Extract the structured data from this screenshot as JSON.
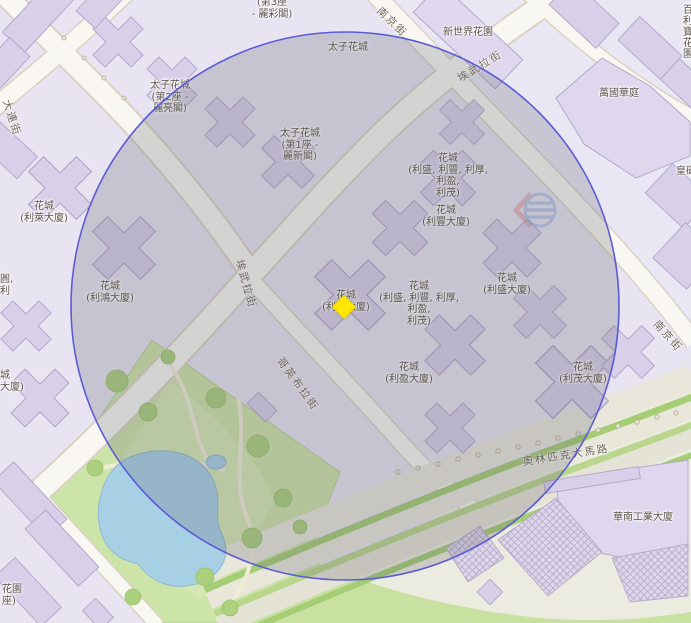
{
  "map": {
    "building_labels": [
      {
        "id": "prince-flower-city",
        "lines": [
          "太子花城"
        ],
        "x": 348,
        "y": 42
      },
      {
        "id": "prince-block3",
        "lines": [
          "(第3座",
          "- 麗彩閣)"
        ],
        "x": 272,
        "y": -3
      },
      {
        "id": "prince-block2",
        "lines": [
          "太子花城",
          "(第2座 -",
          "麗亮閣)"
        ],
        "x": 170,
        "y": 80
      },
      {
        "id": "prince-block1",
        "lines": [
          "太子花城",
          "(第1座 -",
          "麗新閣)"
        ],
        "x": 300,
        "y": 128
      },
      {
        "id": "new-world-garden",
        "lines": [
          "新世界花園"
        ],
        "x": 468,
        "y": 27
      },
      {
        "id": "van-kuok-garden",
        "lines": [
          "萬國華庭"
        ],
        "x": 619,
        "y": 88
      },
      {
        "id": "fa-seng-multi-north",
        "lines": [
          "花城",
          "(利盛, 利豐, 利厚,",
          "利盈,",
          "利茂)"
        ],
        "x": 448,
        "y": 153
      },
      {
        "id": "fa-seng-lei-fong",
        "lines": [
          "花城",
          "(利豐大廈)"
        ],
        "x": 446,
        "y": 205
      },
      {
        "id": "fa-seng-lei-seng",
        "lines": [
          "花城",
          "(利盛大廈)"
        ],
        "x": 507,
        "y": 273
      },
      {
        "id": "fa-seng-lei-loi",
        "lines": [
          "花城",
          "(利萊大廈)"
        ],
        "x": 44,
        "y": 201
      },
      {
        "id": "fragment-yuen",
        "lines": [
          "圓,",
          "利"
        ],
        "x": 0,
        "y": 274,
        "align": "left"
      },
      {
        "id": "fa-seng-lei-hung",
        "lines": [
          "花城",
          "(利鴻大廈)"
        ],
        "x": 110,
        "y": 281
      },
      {
        "id": "fa-seng-multi-central",
        "lines": [
          "花城",
          "(利盛, 利豐, 利厚,",
          "利盈,",
          "利茂)"
        ],
        "x": 419,
        "y": 281
      },
      {
        "id": "fa-seng-marker-building",
        "lines": [
          "花城",
          "(利　大廈)"
        ],
        "x": 346,
        "y": 290
      },
      {
        "id": "fa-seng-lei-ying",
        "lines": [
          "花城",
          "(利盈大廈)"
        ],
        "x": 409,
        "y": 362
      },
      {
        "id": "fa-seng-lei-mao",
        "lines": [
          "花城",
          "(利茂大廈)"
        ],
        "x": 583,
        "y": 362
      },
      {
        "id": "fragment-seng-left",
        "lines": [
          "城",
          "大廈)"
        ],
        "x": 0,
        "y": 370,
        "align": "left"
      },
      {
        "id": "wa-nam-industrial",
        "lines": [
          "華南工業大廈"
        ],
        "x": 643,
        "y": 512
      },
      {
        "id": "fragment-garden-sw",
        "lines": [
          "花園",
          "座)"
        ],
        "x": 2,
        "y": 584,
        "align": "left"
      },
      {
        "id": "fragment-wong-ma",
        "lines": [
          "皇碼"
        ],
        "x": 676,
        "y": 166,
        "align": "left"
      },
      {
        "id": "fragment-pak-lei-po",
        "lines": [
          "百利寶花園"
        ],
        "x": 680,
        "y": 4,
        "vertical": true
      }
    ],
    "street_labels": [
      {
        "id": "rua-dalian",
        "name": "大連街",
        "x": 12,
        "y": 118,
        "rot": 72
      },
      {
        "id": "rua-nam-keng-north",
        "name": "南京街",
        "x": 392,
        "y": 22,
        "rot": 44
      },
      {
        "id": "rua-evora-north",
        "name": "埃武拉街",
        "x": 480,
        "y": 66,
        "rot": -31
      },
      {
        "id": "rua-evora-south",
        "name": "埃武拉街",
        "x": 246,
        "y": 284,
        "rot": 74
      },
      {
        "id": "rua-nam-keng-east",
        "name": "南京街",
        "x": 668,
        "y": 336,
        "rot": 48
      },
      {
        "id": "rua-coimbra",
        "name": "哥英布拉街",
        "x": 298,
        "y": 384,
        "rot": 54
      },
      {
        "id": "av-olimpica",
        "name": "奧林匹克大馬路",
        "x": 566,
        "y": 455,
        "rot": -9
      }
    ],
    "overlay": {
      "circle": {
        "cx": 345,
        "cy": 306,
        "r": 274
      },
      "marker": {
        "x": 344,
        "y": 307
      }
    },
    "colors": {
      "circle_fill": "rgba(98,98,108,0.24)",
      "circle_stroke": "#5b5bd6",
      "marker": "#ffe600",
      "base": "#e8e4f1",
      "road": "#f8f7f2",
      "building": "#d8d0e9",
      "park": "#cde4a9",
      "pond": "#a8d0e5"
    }
  }
}
